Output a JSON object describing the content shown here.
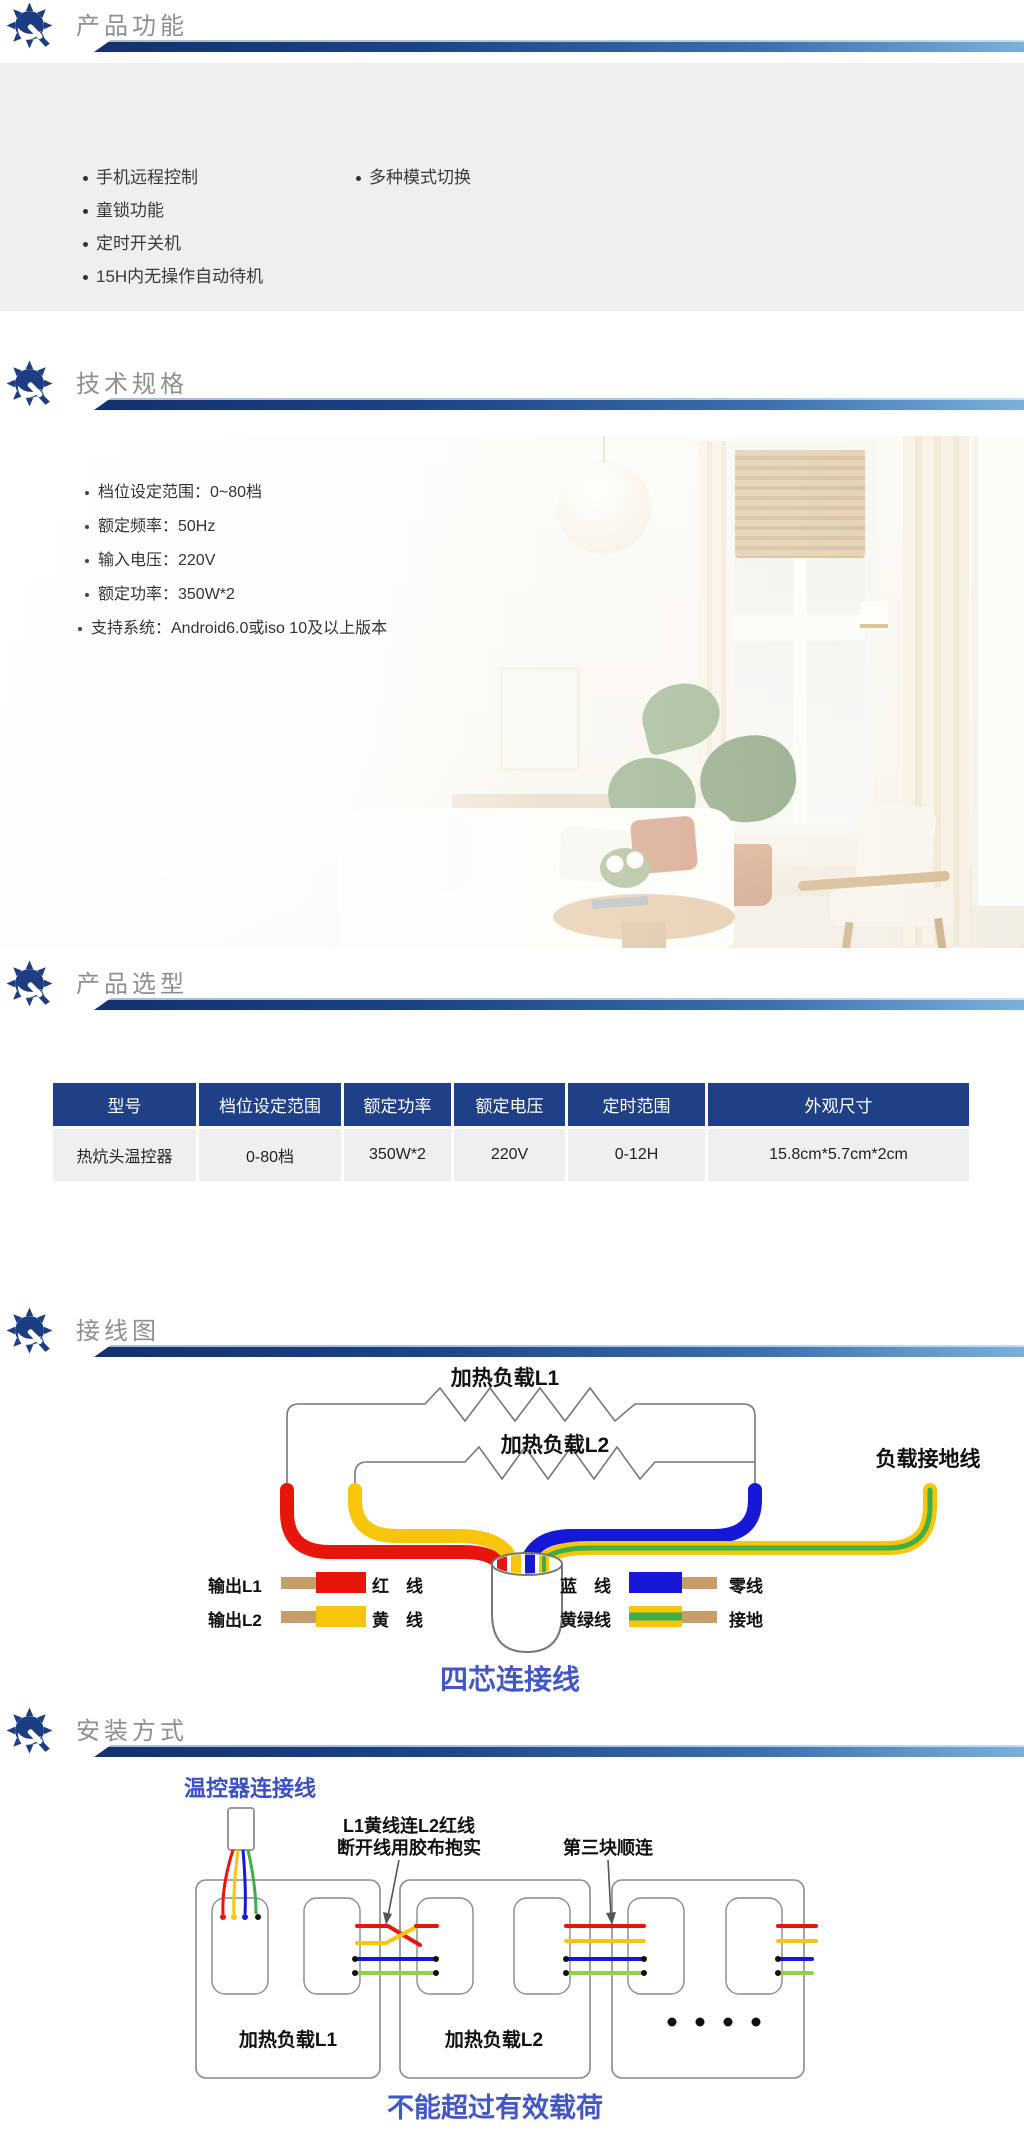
{
  "sections": {
    "features": {
      "title": "产品功能",
      "left": [
        "手机远程控制",
        "童锁功能",
        "定时开关机",
        "15H内无操作自动待机"
      ],
      "right": [
        "多种模式切换"
      ]
    },
    "specs": {
      "title": "技术规格",
      "items": [
        "档位设定范围：0~80档",
        "额定频率：50Hz",
        "输入电压：220V",
        "额定功率：350W*2",
        "支持系统：Android6.0或iso 10及以上版本"
      ]
    },
    "selection": {
      "title": "产品选型",
      "table": {
        "headers": [
          "型号",
          "档位设定范围",
          "额定功率",
          "额定电压",
          "定时范围",
          "外观尺寸"
        ],
        "row": [
          "热炕头温控器",
          "0-80档",
          "350W*2",
          "220V",
          "0-12H",
          "15.8cm*5.7cm*2cm"
        ]
      }
    },
    "wiring": {
      "title": "接线图",
      "load1": "加热负载L1",
      "load2": "加热负载L2",
      "ground": "负载接地线",
      "legend": {
        "out1": "输出L1",
        "out2": "输出L2",
        "red": "红　线",
        "yellow": "黄　线",
        "blue": "蓝　线",
        "yellow_green": "黄绿线",
        "neutral": "零线",
        "earth": "接地"
      },
      "caption": "四芯连接线"
    },
    "install": {
      "title": "安装方式",
      "connector": "温控器连接线",
      "note1_l1": "L1黄线连L2红线",
      "note1_l2": "断开线用胶布抱实",
      "note2": "第三块顺连",
      "mat1": "加热负载L1",
      "mat2": "加热负载L2",
      "caption": "不能超过有效载荷"
    }
  },
  "colors": {
    "header_bar_dark": "#13316c",
    "header_bar_light": "#7cb0da",
    "brand_navy": "#1d3d82",
    "section_bg": "#efefef",
    "table_header_bg": "#1f4086",
    "wire_red": "#e8150d",
    "wire_yellow": "#f7c60a",
    "wire_blue": "#1717d8",
    "wire_green": "#3fae46",
    "wire_copper": "#c79e6a",
    "caption_blue": "#4356c6"
  }
}
